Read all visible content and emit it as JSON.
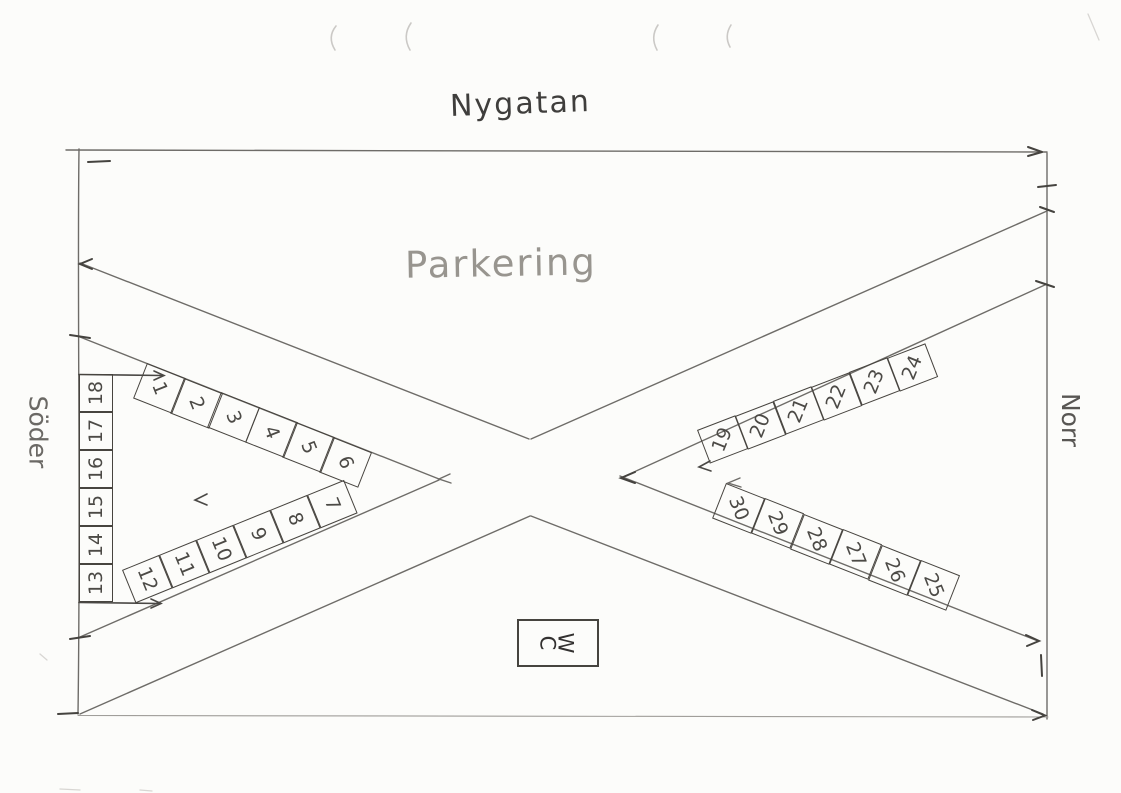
{
  "street_label": "Nygatan",
  "area_label": "Parkering",
  "direction_labels": {
    "west_side": "Söder",
    "east_side": "Norr"
  },
  "wc_label": "WC",
  "parking": {
    "row_1_6": [
      "1",
      "2",
      "3",
      "4",
      "5",
      "6"
    ],
    "row_7_12": [
      "12",
      "11",
      "10",
      "9",
      "8",
      "7"
    ],
    "row_13_18": [
      "18",
      "17",
      "16",
      "15",
      "14",
      "13"
    ],
    "row_19_24": [
      "19",
      "20",
      "21",
      "22",
      "23",
      "24"
    ],
    "row_25_30": [
      "30",
      "29",
      "28",
      "27",
      "26",
      "25"
    ]
  },
  "colors": {
    "pencil": "#6e6c68",
    "pencil_dark": "#45433f",
    "paper": "#fcfcfa"
  }
}
